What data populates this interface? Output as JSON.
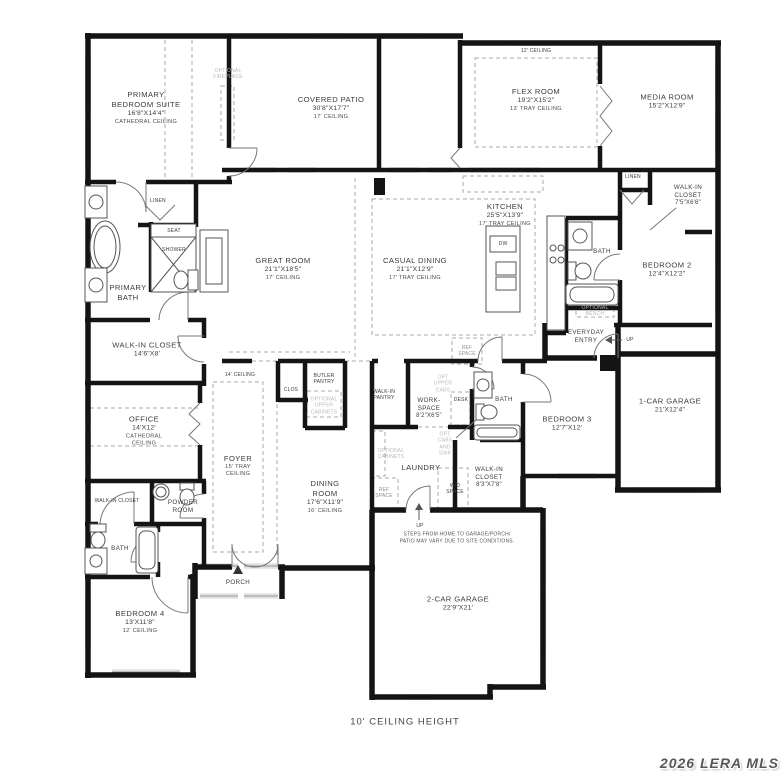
{
  "labels": {
    "primary_suite": {
      "name": "PRIMARY\nBEDROOM SUITE",
      "dims": "16'8\"X14'4\"",
      "ceiling": "CATHEDRAL CEILING"
    },
    "optional_fireplace": {
      "name": "OPTIONAL\nFIREPLACE"
    },
    "covered_patio": {
      "name": "COVERED PATIO",
      "dims": "30'8\"X17'7\"",
      "ceiling": "17' CEILING"
    },
    "flex_ceiling_note": {
      "name": "12' CEILING"
    },
    "flex_room": {
      "name": "FLEX ROOM",
      "dims": "19'2\"X15'2\"",
      "ceiling": "13' TRAY CEILING"
    },
    "media_room": {
      "name": "MEDIA ROOM",
      "dims": "15'2\"X12'9\""
    },
    "linen_hall": {
      "name": "LINEN"
    },
    "walk_in_closet_2": {
      "name": "WALK-IN\nCLOSET",
      "dims": "7'5\"X6'6\""
    },
    "bath_2": {
      "name": "BATH"
    },
    "bedroom_2": {
      "name": "BEDROOM 2",
      "dims": "12'4\"X12'2\""
    },
    "kitchen": {
      "name": "KITCHEN",
      "dims": "25'5\"X13'9\"",
      "ceiling": "17' TRAY CEILING"
    },
    "dishwasher": {
      "name": "DW"
    },
    "ref_space_kitchen": {
      "name": "REF\nSPACE"
    },
    "casual_dining": {
      "name": "CASUAL DINING",
      "dims": "21'1\"X12'9\"",
      "ceiling": "17' TRAY CEILING"
    },
    "great_room": {
      "name": "GREAT ROOM",
      "dims": "21'1\"X18'5\"",
      "ceiling": "17' CEILING"
    },
    "linen_primary": {
      "name": "LINEN"
    },
    "seat": {
      "name": "SEAT"
    },
    "shower": {
      "name": "SHOWER"
    },
    "primary_bath": {
      "name": "PRIMARY\nBATH"
    },
    "primary_closet": {
      "name": "WALK-IN CLOSET",
      "dims": "14'6\"X8'"
    },
    "optional_bench": {
      "name": "OPTIONAL\nBENCH"
    },
    "everyday_entry": {
      "name": "EVERYDAY\nENTRY"
    },
    "up_entry": {
      "name": "UP"
    },
    "bedroom_3": {
      "name": "BEDROOM 3",
      "dims": "12'7\"X12'"
    },
    "one_car_garage": {
      "name": "1-CAR GARAGE",
      "dims": "21'X12'4\""
    },
    "bath_3": {
      "name": "BATH"
    },
    "desk": {
      "name": "DESK"
    },
    "opt_upper_cabs": {
      "name": "OPT\nUPPER\nCABS"
    },
    "workspace": {
      "name": "WORK-\nSPACE",
      "dims": "8'2\"X6'5\""
    },
    "walk_in_pantry": {
      "name": "WALK-IN\nPANTRY"
    },
    "butler_pantry": {
      "name": "BUTLER\nPANTRY"
    },
    "optional_upper_cabinets": {
      "name": "OPTIONAL\nUPPER\nCABINETS"
    },
    "clos": {
      "name": "CLOS"
    },
    "hall_ceiling_note": {
      "name": "14' CEILING"
    },
    "foyer": {
      "name": "FOYER",
      "ceiling": "15' TRAY\nCEILING"
    },
    "office": {
      "name": "OFFICE",
      "dims": "14'X12'",
      "ceiling": "CATHEDRAL\nCEILING"
    },
    "walk_in_closet_4": {
      "name": "WALK-IN CLOSET"
    },
    "powder_room": {
      "name": "POWDER\nROOM"
    },
    "bath_4": {
      "name": "BATH"
    },
    "opt_cabs_sink": {
      "name": "OPT\nCABS\nAND\nSINK"
    },
    "optional_cabinets": {
      "name": "OPTIONAL\nCABINETS"
    },
    "laundry": {
      "name": "LAUNDRY"
    },
    "ref_space_laundry": {
      "name": "REF\nSPACE"
    },
    "wd_space": {
      "name": "W/D\nSPACE"
    },
    "walk_in_closet_3": {
      "name": "WALK-IN\nCLOSET",
      "dims": "8'3\"X7'8\""
    },
    "dining_room": {
      "name": "DINING\nROOM",
      "dims": "17'6\"X11'9\"",
      "ceiling": "16' CEILING"
    },
    "bedroom_4": {
      "name": "BEDROOM 4",
      "dims": "13'X11'8\"",
      "ceiling": "12' CEILING"
    },
    "porch": {
      "name": "PORCH"
    },
    "up_garage": {
      "name": "UP"
    },
    "steps_note": {
      "name": "STEPS FROM HOME TO GARAGE/PORCH/\nPATIO MAY VARY DUE TO SITE CONDITIONS."
    },
    "two_car_garage": {
      "name": "2-CAR GARAGE",
      "dims": "22'9\"X21'"
    }
  },
  "footer": {
    "ceiling_note": "10' CEILING HEIGHT"
  },
  "watermark": {
    "text": "2026 LERA MLS"
  },
  "colors": {
    "wall": "#141414",
    "window": "#9a9a9a",
    "optional_gray": "#b9b9b9",
    "text": "#3c3c3c"
  }
}
